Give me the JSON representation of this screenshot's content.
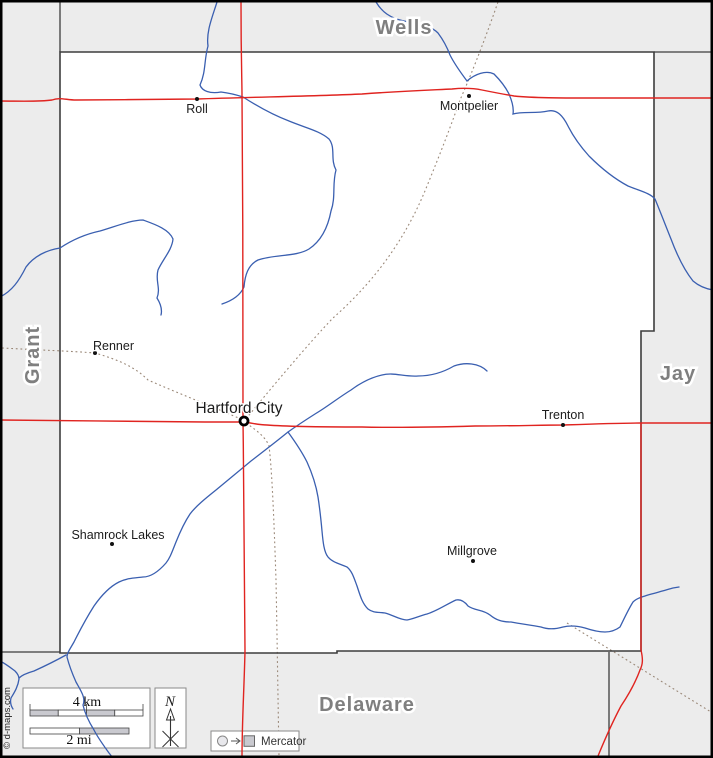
{
  "map": {
    "credit": "© d-maps.com",
    "colors": {
      "outside_fill": "#ececec",
      "county_fill": "#ffffff",
      "border": "#3d3d3d",
      "frame": "#000000",
      "road_red": "#e02420",
      "river_blue": "#3a5fb0",
      "railroad": "#9a8878",
      "county_label": "#7f7f7f",
      "legend_box_stroke": "#8a8a8a",
      "bar_gray": "#c9c9cf"
    },
    "neighbor_labels": [
      {
        "name": "Wells",
        "x": 404,
        "y": 34,
        "rotate": 0,
        "size": 20
      },
      {
        "name": "Grant",
        "x": 32,
        "y": 355,
        "rotate": -90,
        "size": 20
      },
      {
        "name": "Jay",
        "x": 678,
        "y": 380,
        "rotate": 0,
        "size": 20
      },
      {
        "name": "Delaware",
        "x": 367,
        "y": 711,
        "rotate": 0,
        "size": 20
      }
    ],
    "cities": [
      {
        "name": "Roll",
        "x": 197,
        "y": 99,
        "label_x": 197,
        "label_y": 113,
        "anchor": "middle",
        "size": 12.5,
        "seat": false
      },
      {
        "name": "Montpelier",
        "x": 469,
        "y": 96,
        "label_x": 469,
        "label_y": 110,
        "anchor": "middle",
        "size": 12.5,
        "seat": false
      },
      {
        "name": "Renner",
        "x": 95,
        "y": 353,
        "label_x": 93,
        "label_y": 350,
        "anchor": "start",
        "size": 12.5,
        "seat": false
      },
      {
        "name": "Hartford City",
        "x": 244,
        "y": 421,
        "label_x": 239,
        "label_y": 413,
        "anchor": "middle",
        "size": 15.5,
        "seat": true
      },
      {
        "name": "Trenton",
        "x": 563,
        "y": 425,
        "label_x": 563,
        "label_y": 419,
        "anchor": "middle",
        "size": 12.5,
        "seat": false
      },
      {
        "name": "Shamrock Lakes",
        "x": 112,
        "y": 544,
        "label_x": 118,
        "label_y": 539,
        "anchor": "middle",
        "size": 12.5,
        "seat": false
      },
      {
        "name": "Millgrove",
        "x": 473,
        "y": 561,
        "label_x": 472,
        "label_y": 555,
        "anchor": "middle",
        "size": 12.5,
        "seat": false
      }
    ],
    "legend": {
      "scale_box": [
        23,
        688,
        127,
        60
      ],
      "north_box": [
        155,
        688,
        31,
        60
      ],
      "mercator_box": [
        211,
        731,
        88,
        20
      ],
      "km_bar": {
        "x": 30,
        "y": 710,
        "w": 113,
        "h": 6,
        "segs": 4,
        "invert": false
      },
      "mi_bar": {
        "x": 30,
        "y": 728,
        "w": 99,
        "h": 6,
        "segs": 2,
        "invert": true
      },
      "km_label": "4 km",
      "mi_label": "2 mi",
      "km_label_pos": [
        87,
        706
      ],
      "mi_label_pos": [
        79,
        744
      ],
      "north_label": "N",
      "north_label_pos": [
        170,
        706
      ],
      "projection_label": "Mercator",
      "projection_label_pos": [
        261,
        745
      ]
    },
    "geometry": {
      "county_outline": "M60,52 L654,52 L654,331 L641,331 L641,651 L337,651 L337,653 L60,653 Z",
      "border_extensions": [
        "M60,2 L60,52",
        "M654,52 L711,52",
        "M2,652 L60,652",
        "M609,652 L609,756"
      ],
      "railroads": [
        "M498,2 C482,48 468,82 460,100 C448,134 438,159 427,186 C403,246 368,287 333,318 C308,344 268,392 245,420",
        "M2,348 C38,350 70,351 95,353 C119,360 135,367 148,380 C180,394 216,408 243,420",
        "M246,423 C259,432 266,438 269,446 C272,470 274,520 276,580 C277,630 278,700 279,756",
        "M567,623 L711,712"
      ],
      "rivers": [
        "M217,2 C212,18 206,32 208,46 C204,60 206,72 200,85 C202,91 210,94 221,92 C229,93 237,95 243,97 C257,106 273,115 289,121 C306,128 320,131 329,139 C336,148 330,159 336,170 C332,184 336,197 331,211 C328,227 321,241 309,249 C296,257 275,254 258,260 C248,265 245,275 244,287 C240,296 231,301 222,304",
        "M376,2 C382,12 390,18 404,21 C418,24 430,25 438,33 C444,41 447,47 450,55 C455,65 461,73 467,81 C475,74 486,70 494,74 C501,81 506,88 509,94 C512,101 514,108 513,114 C523,111 536,114 548,111 C557,109 563,116 568,126 C573,136 580,146 589,156 C600,167 613,178 628,186 C640,191 650,193 655,199 C660,211 665,224 671,239 C677,255 685,271 693,281 C700,287 707,289 713,290",
        "M0,297 C12,291 19,281 26,267 C34,256 47,250 60,248 C72,240 86,234 100,231 C114,227 131,220 143,220 C154,224 169,229 173,239 C172,250 163,259 158,270 C155,281 161,288 157,298 C162,306 162,311 161,315",
        "M487,371 C479,363 465,362 454,366 C442,373 430,376 418,376 C404,377 394,372 382,375 C369,378 359,384 351,390 C338,398 327,407 315,414 C304,421 295,427 288,432 C277,441 264,451 251,461 C239,471 227,481 216,490 C206,498 196,506 190,514 C184,523 180,532 176,542 C172,552 170,558 166,563 C159,571 151,577 143,577 C135,578 127,578 119,582 C109,587 101,596 94,606 C87,617 80,630 74,642 C70,649 67,653 67,657 C69,665 72,673 76,682 C81,691 86,698 83,705 C85,714 89,722 94,730 C98,738 104,746 109,753 L113,758",
        "M66,655 C57,660 45,666 34,671 C27,673 22,675 19,678",
        "M0,661 C6,664 11,668 15,671 C18,674 19,676 19,679 C18,687 14,693 11,698 C10,702 11,706 13,709",
        "M288,432 C296,443 302,452 307,462 C312,473 316,485 318,497 C320,510 321,520 322,531 C323,542 324,552 328,557 C333,563 341,564 347,567 C352,571 354,578 357,586 C360,595 362,603 368,609 C373,613 379,612 385,613 C393,615 400,620 407,620 C413,619 419,616 427,614 C437,611 447,604 456,600 C461,599 465,602 468,606 C475,611 482,609 490,615 C496,620 502,622 511,622 C521,624 531,625 541,627 C549,630 556,629 563,627 C571,625 578,626 585,628 C591,630 598,632 605,632 C611,632 616,630 620,627 C624,619 628,610 633,602 C637,598 642,597 648,595 C656,593 666,590 673,588 L679,587"
      ],
      "roads": [
        "M0,101 C18,101 38,102 52,100 C60,97 66,100 76,100 C116,100 158,99 197,99 C258,97 320,96 362,94 C402,91 432,90 452,89 C462,88 472,88 482,90 C492,92 502,94 514,96 C534,98 560,98 592,98 L713,98",
        "M241,2 C241,60 242,80 242,96 C243,200 243,330 243,421 C244,500 245,580 245,651 C244,692 242,722 242,758",
        "M0,420 C60,421 150,421 205,422 C222,422 236,422 244,422 C252,423 259,425 267,425 C292,427 330,427 362,427 C402,428 440,427 475,426 C512,426 542,425 563,425 C592,424 620,423 641,423 L713,423",
        "M641,423 L641,650 C643,659 643,664 640,670 C636,681 629,694 621,706 C613,721 605,739 598,756"
      ]
    }
  }
}
